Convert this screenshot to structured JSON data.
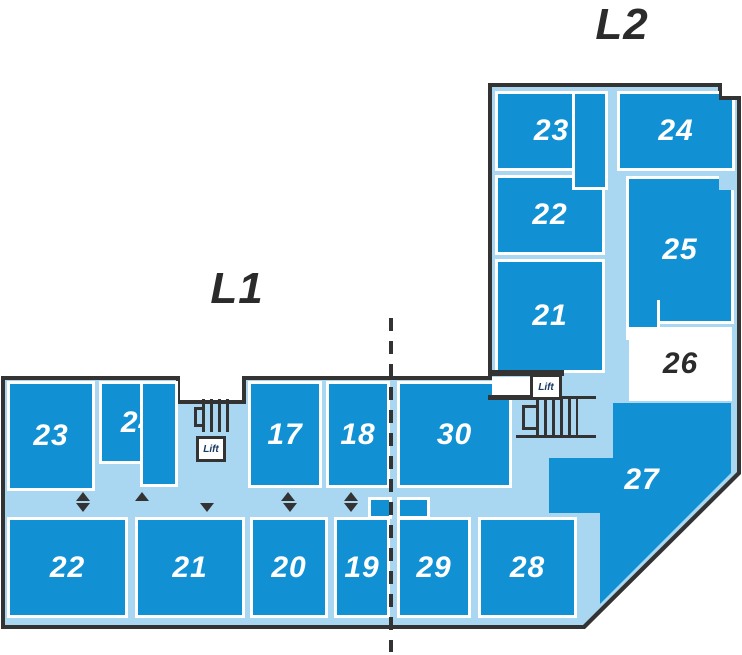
{
  "labels": {
    "level1": "L1",
    "level2": "L2"
  },
  "room_numbers": {
    "l2_23": "23",
    "l2_24": "24",
    "l2_22": "22",
    "l2_25": "25",
    "l2_21": "21",
    "l2_26": "26",
    "l2_27": "27",
    "l1_23": "23",
    "l1_24": "24",
    "l1_17": "17",
    "l1_18": "18",
    "l1_30": "30",
    "l1_22": "22",
    "l1_21": "21",
    "l1_20": "20",
    "l1_19": "19",
    "l1_29": "29",
    "l1_28": "28"
  },
  "lifts": {
    "l1": "Lift",
    "l2": "Lift"
  },
  "colors": {
    "room_blue": "#1191d3",
    "corridor_blue": "#a9d7f1",
    "outline": "#333333",
    "number_text": "#ffffff",
    "dark_text": "#2b2b2b",
    "lift_text": "#163a63"
  }
}
